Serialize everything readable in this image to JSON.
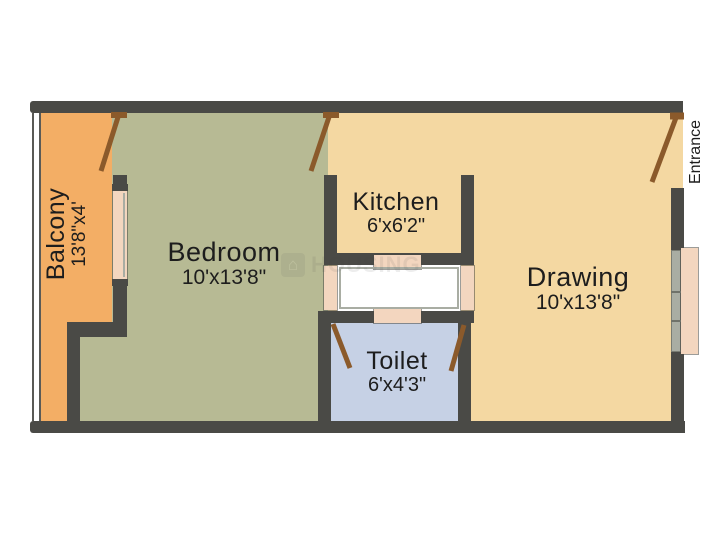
{
  "plan": {
    "entrance_label": "Entrance",
    "watermark": "HOUSING",
    "icons": {
      "watermark_house": "⌂"
    },
    "rooms": [
      {
        "id": "balcony",
        "name": "Balcony",
        "size": "13'8\"x4'"
      },
      {
        "id": "bedroom",
        "name": "Bedroom",
        "size": "10'x13'8\""
      },
      {
        "id": "kitchen",
        "name": "Kitchen",
        "size": "6'x6'2\""
      },
      {
        "id": "drawing",
        "name": "Drawing",
        "size": "10'x13'8\""
      },
      {
        "id": "toilet",
        "name": "Toilet",
        "size": "6'x4'3\""
      }
    ],
    "colors": {
      "wall": "#4a4a46",
      "balcony": "#f3ae65",
      "bedroom": "#b7ba94",
      "kitchen": "#f4d8a2",
      "drawing": "#f4d8a2",
      "toilet": "#c6d1e5",
      "sill": "#f3d6bf",
      "door": "#8b5a2b",
      "glass": "#a9ada3",
      "background": "#ffffff",
      "text": "#1d1d1d"
    }
  }
}
